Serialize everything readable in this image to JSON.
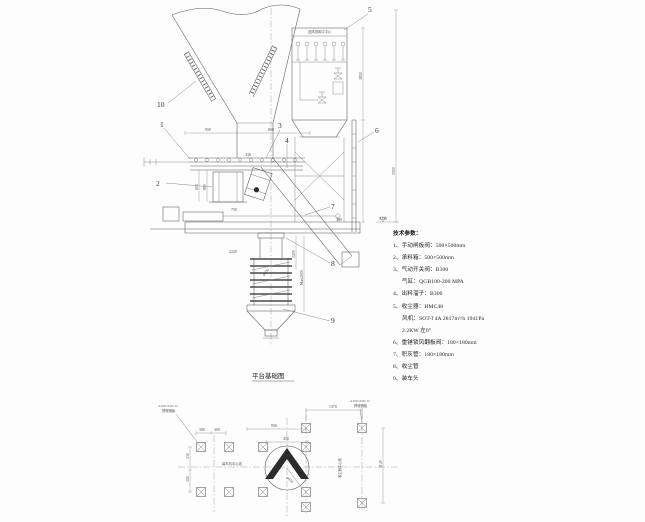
{
  "elevation": {
    "part_labels": [
      "1",
      "2",
      "3",
      "4",
      "5",
      "6",
      "7",
      "8",
      "9",
      "10"
    ],
    "collector_top_label": "送风排风口中心",
    "dims": {
      "top_left": "950",
      "top_right": "800",
      "box_left_inner": "600",
      "box_left_outer": "800",
      "chute_width": "330",
      "box_bottom": "750",
      "right_small": "390",
      "collector_height": "1850",
      "column_height": "3500",
      "pipe_top": "2220",
      "pipe_upper": "1200",
      "pipe_travel": "Max2000",
      "pipe_dia": "φ600",
      "platform_level": "5.00"
    }
  },
  "tech_params": {
    "title": "技术参数：",
    "lines": [
      "1、手动闸板阀：500×500mm",
      "2、承料箱：500×500mm",
      "3、气动开关阀：B300",
      "气缸：QGB100-200 MPA",
      "4、出料溜子：B300",
      "5、收尘器：HMC48",
      "风机：SOT-Ⅰ 4A 2817m³/h 1941Pa",
      "2.2KW 左0°",
      "6、重锤锁风翻板阀：180×180mm",
      "7、积灰管：180×180mm",
      "8、收尘管",
      "9、装车头"
    ]
  },
  "plan": {
    "title": "平台基础图",
    "centerline_h": "装车机中心线",
    "centerline_v": "收尘器中心线",
    "hole_dia": "φ650",
    "note_left": {
      "line1": "4-250×250×12",
      "line2": "预埋钢板"
    },
    "note_right": {
      "line1": "4-250×250×12",
      "line2": "预埋钢板"
    },
    "dims": {
      "col_spacing_1": "300",
      "col_spacing_2": "300",
      "center_offset": "950",
      "chevron_width": "450",
      "right_span": "1370",
      "right_height": "1140",
      "left_height_1": "130",
      "left_height_2": "150"
    }
  }
}
